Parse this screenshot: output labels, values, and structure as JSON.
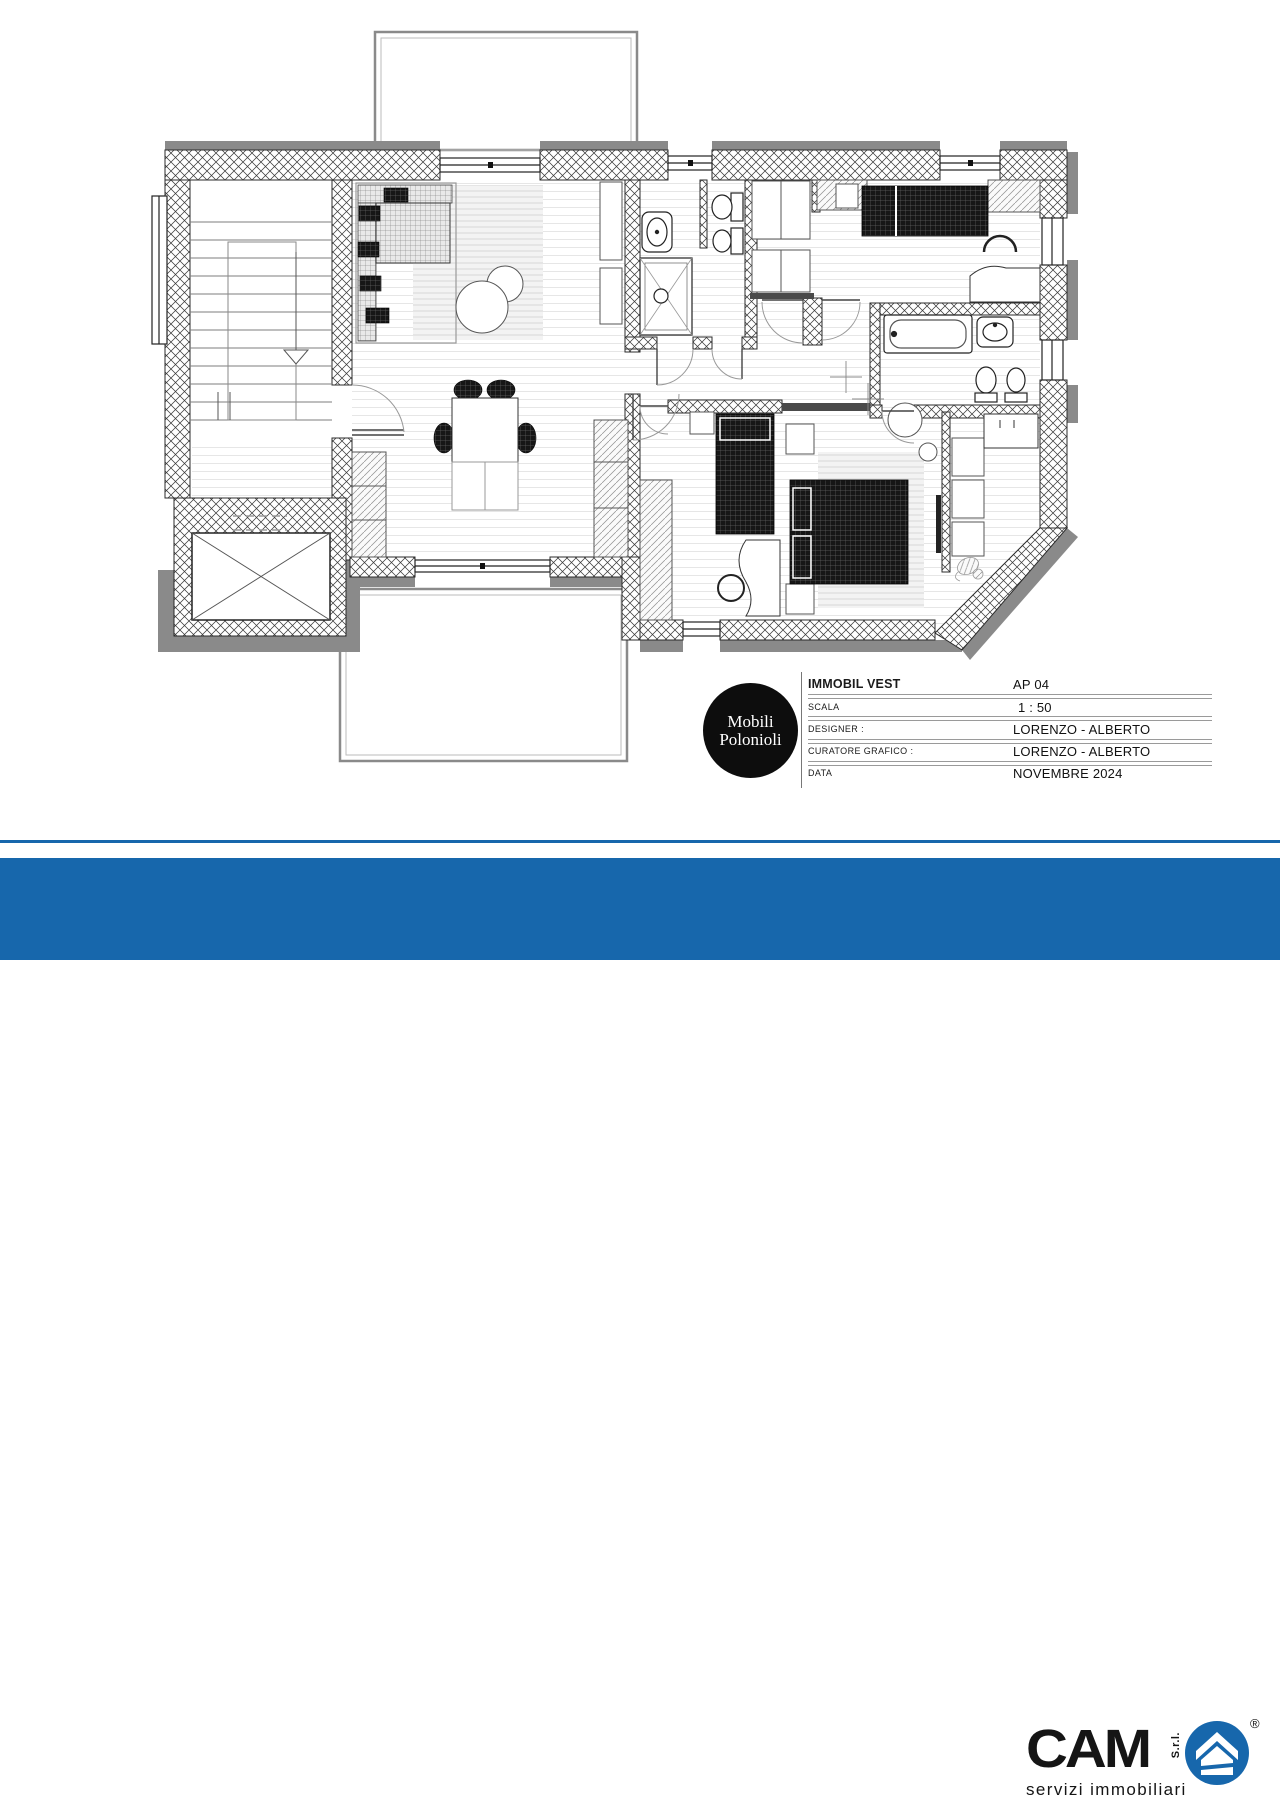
{
  "colors": {
    "accent_blue": "#1767ac",
    "wall_gray": "#8a8a8a",
    "ink": "#1a1a1a"
  },
  "title_block": {
    "logo_line1": "Mobili",
    "logo_line2": "Polonioli",
    "rows": [
      {
        "label": "IMMOBIL VEST",
        "value": "AP 04"
      },
      {
        "label": "SCALA",
        "value": "1 : 50"
      },
      {
        "label": "DESIGNER :",
        "value": "LORENZO - ALBERTO"
      },
      {
        "label": "CURATORE GRAFICO :",
        "value": "LORENZO - ALBERTO"
      },
      {
        "label": "DATA",
        "value": "NOVEMBRE 2024"
      }
    ]
  },
  "footer": {
    "title_line1": "APPARTAMENTO QUADRILOCALE",
    "title_line2": "PISOGNE",
    "cam": {
      "name": "CAM",
      "suffix": "S.r.l.",
      "registered": "®",
      "tagline": "servizi immobiliari"
    }
  }
}
